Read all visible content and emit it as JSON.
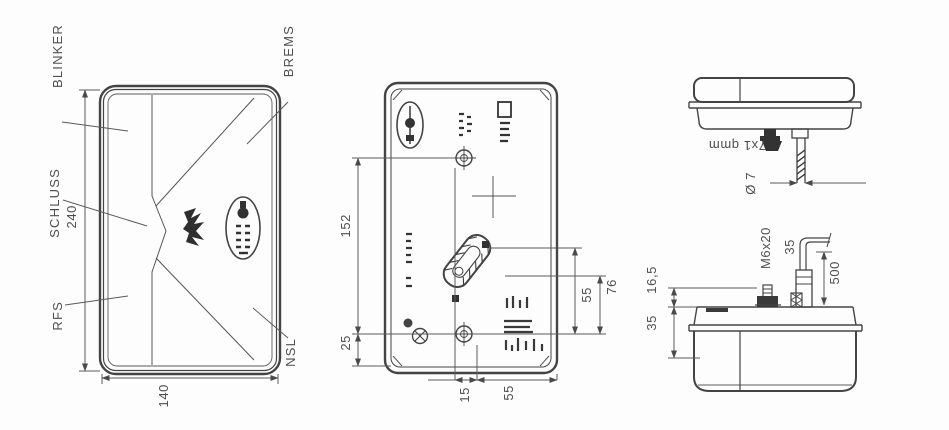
{
  "drawing": {
    "front_view": {
      "labels": {
        "blinker": "BLINKER",
        "schluss": "SCHLUSS",
        "rfs": "RFS",
        "brems": "BREMS",
        "nsl": "NSL"
      },
      "dimensions": {
        "height": "240",
        "width": "140"
      }
    },
    "rear_view": {
      "dimensions": {
        "hole_spacing": "152",
        "bottom_offset": "25",
        "connector_top": "76",
        "connector_bottom": "55",
        "hole_offset": "15",
        "edge_offset": "55"
      }
    },
    "top_view": {
      "cable_spec": "7x1 qmm",
      "cable_diameter": "Ø 7"
    },
    "side_view": {
      "stud_thread": "M6x20",
      "gland_offset": "35",
      "cable_length": "500",
      "stud_height": "16,5",
      "body_depth": "35"
    }
  }
}
